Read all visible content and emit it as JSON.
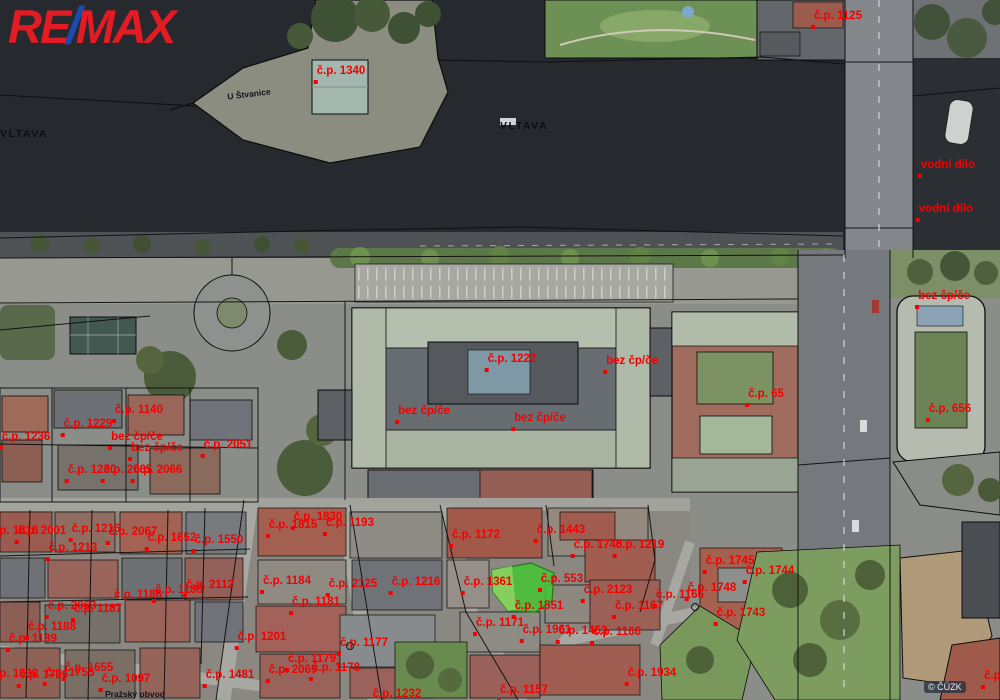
{
  "branding": {
    "re": "RE",
    "slash": "/",
    "max": "MAX",
    "red": "#e31b23",
    "blue": "#1c4bad"
  },
  "map": {
    "watermark": "© ČÚZK",
    "colors": {
      "parcel_label": "#f50000",
      "highlight": "#47c336",
      "highlight_light": "#8ed262",
      "water": "#262a2f"
    },
    "labels": [
      {
        "text": "VLTAVA",
        "x": 24,
        "y": 129,
        "kind": "water",
        "dot": false
      },
      {
        "text": "VLTAVA",
        "x": 524,
        "y": 121,
        "kind": "water",
        "dot": false
      },
      {
        "text": "U Štvanice",
        "x": 249,
        "y": 90,
        "kind": "street",
        "dot": false,
        "rot": -7
      },
      {
        "text": "Pražský obvod",
        "x": 135,
        "y": 690,
        "kind": "street",
        "dot": false
      },
      {
        "text": "č.p. 1125",
        "x": 838,
        "y": 11
      },
      {
        "text": "č.p. 1340",
        "x": 341,
        "y": 66
      },
      {
        "text": "vodní dílo",
        "x": 948,
        "y": 160
      },
      {
        "text": "vodní dílo",
        "x": 946,
        "y": 204
      },
      {
        "text": "bez čp/če",
        "x": 944,
        "y": 291
      },
      {
        "text": "č.p. 1222",
        "x": 512,
        "y": 354
      },
      {
        "text": "bez čp/če",
        "x": 632,
        "y": 356
      },
      {
        "text": "bez čp/če",
        "x": 424,
        "y": 406
      },
      {
        "text": "bez čp/če",
        "x": 540,
        "y": 413
      },
      {
        "text": "č.p. 65",
        "x": 766,
        "y": 389
      },
      {
        "text": "č.p. 656",
        "x": 950,
        "y": 404
      },
      {
        "text": "č.p. 1140",
        "x": 139,
        "y": 405
      },
      {
        "text": "č.p. 1229",
        "x": 88,
        "y": 419
      },
      {
        "text": "č.p. 1236",
        "x": 26,
        "y": 432
      },
      {
        "text": "bez čp/če",
        "x": 137,
        "y": 432
      },
      {
        "text": "bez čp/če",
        "x": 157,
        "y": 443
      },
      {
        "text": "č.p. 2051",
        "x": 228,
        "y": 440
      },
      {
        "text": "č.p. 1230",
        "x": 92,
        "y": 465
      },
      {
        "text": "č.p. 2065",
        "x": 128,
        "y": 465
      },
      {
        "text": "č.p. 2066",
        "x": 158,
        "y": 465
      },
      {
        "text": "č.p. 1818",
        "x": 14,
        "y": 526
      },
      {
        "text": "č.p. 2001",
        "x": 42,
        "y": 526
      },
      {
        "text": "č.p. 1216",
        "x": 96,
        "y": 524
      },
      {
        "text": "č.p. 2067",
        "x": 133,
        "y": 527
      },
      {
        "text": "č.p. 1652",
        "x": 172,
        "y": 533
      },
      {
        "text": "č.p. 1550",
        "x": 219,
        "y": 535
      },
      {
        "text": "č.p. 1213",
        "x": 73,
        "y": 543
      },
      {
        "text": "č.p. 1815",
        "x": 293,
        "y": 520
      },
      {
        "text": "č.p. 1830",
        "x": 318,
        "y": 512
      },
      {
        "text": "č.p. 1193",
        "x": 350,
        "y": 518
      },
      {
        "text": "č.p. 1172",
        "x": 476,
        "y": 530
      },
      {
        "text": "č.p. 1443",
        "x": 561,
        "y": 525
      },
      {
        "text": "č.p. 1746",
        "x": 598,
        "y": 540
      },
      {
        "text": "č.p. 1219",
        "x": 640,
        "y": 540
      },
      {
        "text": "č.p. 2112",
        "x": 210,
        "y": 580
      },
      {
        "text": "č.p. 1185",
        "x": 179,
        "y": 585
      },
      {
        "text": "č.p. 1186",
        "x": 138,
        "y": 590
      },
      {
        "text": "č.p. 2063",
        "x": 72,
        "y": 601
      },
      {
        "text": "č.p. 1187",
        "x": 98,
        "y": 604
      },
      {
        "text": "č.p. 1184",
        "x": 287,
        "y": 576
      },
      {
        "text": "č.p. 2125",
        "x": 353,
        "y": 579
      },
      {
        "text": "č.p. 1216",
        "x": 416,
        "y": 577
      },
      {
        "text": "č.p. 1181",
        "x": 316,
        "y": 597
      },
      {
        "text": "č.p. 1361",
        "x": 488,
        "y": 577
      },
      {
        "text": "č.p. 553",
        "x": 562,
        "y": 574
      },
      {
        "text": "č.p. 2123",
        "x": 608,
        "y": 585
      },
      {
        "text": "č.p. 1551",
        "x": 539,
        "y": 601
      },
      {
        "text": "č.p. 1167",
        "x": 639,
        "y": 601
      },
      {
        "text": "č.p. 1166",
        "x": 680,
        "y": 590
      },
      {
        "text": "č.p. 1748",
        "x": 712,
        "y": 583
      },
      {
        "text": "č.p. 1745",
        "x": 730,
        "y": 556
      },
      {
        "text": "č.p. 1744",
        "x": 770,
        "y": 566
      },
      {
        "text": "č.p. 1743",
        "x": 741,
        "y": 608
      },
      {
        "text": "č.p. 1171",
        "x": 500,
        "y": 618
      },
      {
        "text": "č.p. 1961",
        "x": 547,
        "y": 625
      },
      {
        "text": "č.p. 1463",
        "x": 583,
        "y": 626
      },
      {
        "text": "č.p. 1166",
        "x": 617,
        "y": 627
      },
      {
        "text": "č.p. 1188",
        "x": 52,
        "y": 622
      },
      {
        "text": "č.p. 1189",
        "x": 33,
        "y": 634
      },
      {
        "text": "č.p. 1201",
        "x": 262,
        "y": 632
      },
      {
        "text": "č.p. 1177",
        "x": 364,
        "y": 638
      },
      {
        "text": "č.p. 1179",
        "x": 312,
        "y": 654
      },
      {
        "text": "č.p. 1178",
        "x": 336,
        "y": 663
      },
      {
        "text": "č.p. 2069",
        "x": 293,
        "y": 665
      },
      {
        "text": "č.p. 1655",
        "x": 89,
        "y": 663
      },
      {
        "text": "č.p. 1755",
        "x": 70,
        "y": 668
      },
      {
        "text": "č.p. 1736",
        "x": 44,
        "y": 670
      },
      {
        "text": "č.p. 1038",
        "x": 14,
        "y": 669
      },
      {
        "text": "č.p. 1097",
        "x": 126,
        "y": 674
      },
      {
        "text": "č.p. 1481",
        "x": 230,
        "y": 670
      },
      {
        "text": "č.p. 1232",
        "x": 397,
        "y": 689
      },
      {
        "text": "č.p. 1157",
        "x": 524,
        "y": 685
      },
      {
        "text": "č.p. 1934",
        "x": 652,
        "y": 668
      },
      {
        "text": "č.p.",
        "x": 994,
        "y": 671
      }
    ]
  }
}
